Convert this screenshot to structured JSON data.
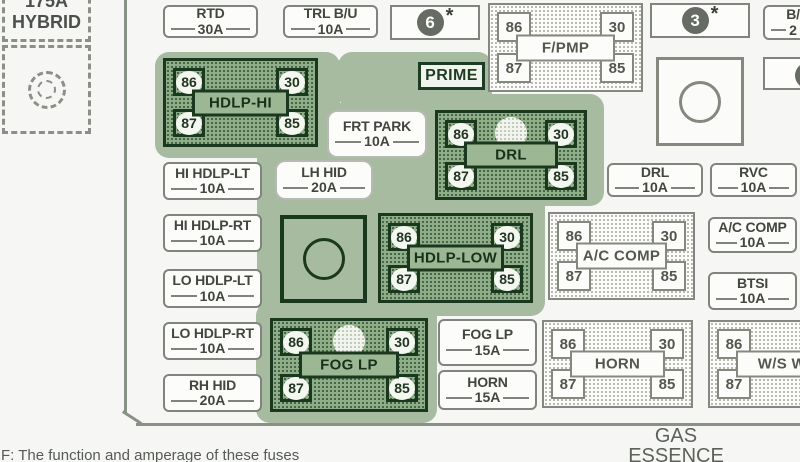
{
  "colors": {
    "highlight_green": "#a6bb9f",
    "relay_green_fill": "#90ad89",
    "relay_green_border": "#1a381e",
    "relay_gray_border": "#84887e",
    "panel_line": "#899086",
    "text": "#42463f",
    "badge_circle": "#666b64"
  },
  "hybrid": {
    "amp": "175A",
    "name": "HYBRID"
  },
  "prime": {
    "label": "PRIME"
  },
  "badges": {
    "b6": {
      "num": "6",
      "star": "*"
    },
    "b3": {
      "num": "3",
      "star": "*"
    }
  },
  "fuses": {
    "rtd": {
      "label": "RTD",
      "amp": "30A"
    },
    "trl_bu": {
      "label": "TRL B/U",
      "amp": "10A"
    },
    "frt_park": {
      "label": "FRT PARK",
      "amp": "10A"
    },
    "lh_hid": {
      "label": "LH HID",
      "amp": "20A"
    },
    "hi_hdlp_lt": {
      "label": "HI HDLP-LT",
      "amp": "10A"
    },
    "hi_hdlp_rt": {
      "label": "HI HDLP-RT",
      "amp": "10A"
    },
    "lo_hdlp_lt": {
      "label": "LO HDLP-LT",
      "amp": "10A"
    },
    "lo_hdlp_rt": {
      "label": "LO HDLP-RT",
      "amp": "10A"
    },
    "rh_hid": {
      "label": "RH HID",
      "amp": "20A"
    },
    "drl": {
      "label": "DRL",
      "amp": "10A"
    },
    "rvc": {
      "label": "RVC",
      "amp": "10A"
    },
    "ac_comp": {
      "label": "A/C COMP",
      "amp": "10A"
    },
    "btsi": {
      "label": "BTSI",
      "amp": "10A"
    },
    "fog_lp": {
      "label": "FOG LP",
      "amp": "15A"
    },
    "horn": {
      "label": "HORN",
      "amp": "15A"
    },
    "bu_partial": {
      "label": "B/",
      "amp": "2"
    }
  },
  "relays": {
    "hdlp_hi": {
      "label": "HDLP-HI",
      "t86": "86",
      "t30": "30",
      "t87": "87",
      "t85": "85"
    },
    "f_pmp": {
      "label": "F/PMP",
      "t86": "86",
      "t30": "30",
      "t87": "87",
      "t85": "85"
    },
    "drl": {
      "label": "DRL",
      "t86": "86",
      "t30": "30",
      "t87": "87",
      "t85": "85"
    },
    "hdlp_low": {
      "label": "HDLP-LOW",
      "t86": "86",
      "t30": "30",
      "t87": "87",
      "t85": "85"
    },
    "ac_comp": {
      "label": "A/C COMP",
      "t86": "86",
      "t30": "30",
      "t87": "87",
      "t85": "85"
    },
    "fog_lp": {
      "label": "FOG LP",
      "t86": "86",
      "t30": "30",
      "t87": "87",
      "t85": "85"
    },
    "horn": {
      "label": "HORN",
      "t86": "86",
      "t30": "30",
      "t87": "87",
      "t85": "85"
    },
    "ws_wa": {
      "label": "W/S WA",
      "t86": "86",
      "t87": "87"
    }
  },
  "footer": {
    "gas": "GAS",
    "essence": "ESSENCE",
    "note": "F: The function and amperage of these fuses"
  }
}
